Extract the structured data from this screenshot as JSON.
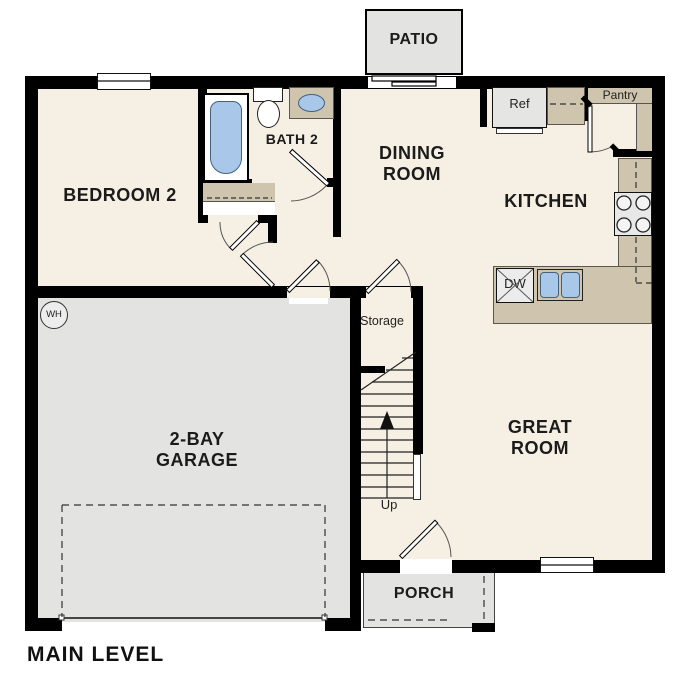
{
  "floor_plan": {
    "title": "MAIN LEVEL",
    "rooms": {
      "bedroom2": {
        "label": "BEDROOM 2"
      },
      "bath2": {
        "label": "BATH 2"
      },
      "dining": {
        "line1": "DINING",
        "line2": "ROOM"
      },
      "kitchen": {
        "label": "KITCHEN"
      },
      "great_room": {
        "line1": "GREAT",
        "line2": "ROOM"
      },
      "garage": {
        "line1": "2-BAY",
        "line2": "GARAGE"
      },
      "storage": {
        "label": "Storage"
      }
    },
    "outdoor": {
      "patio": {
        "label": "PATIO"
      },
      "porch": {
        "label": "PORCH"
      }
    },
    "fixtures": {
      "refrigerator": {
        "label": "Ref"
      },
      "pantry": {
        "label": "Pantry"
      },
      "dishwasher": {
        "label": "DW"
      },
      "water_heater": {
        "label": "WH"
      },
      "stairs": {
        "direction_label": "Up"
      }
    },
    "colors": {
      "wall": "#000000",
      "interior_floor": "#f6efe3",
      "garage_floor": "#e3e3e2",
      "outdoor_surface": "#e3e3e2",
      "counter": "#cfc4ad",
      "plumbing_blue": "#a9c8e9"
    }
  }
}
